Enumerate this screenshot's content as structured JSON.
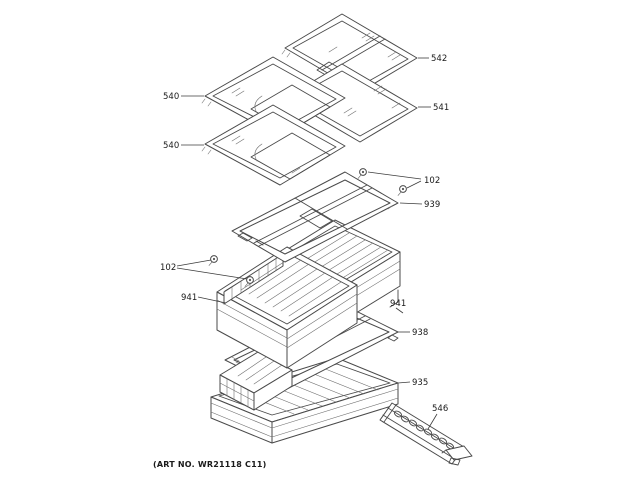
{
  "figure": {
    "art_no": "(ART NO. WR21118 C11)"
  },
  "callouts": {
    "shelf_542": "542",
    "shelf_540_upper": "540",
    "shelf_541": "541",
    "shelf_540_lower": "540",
    "fasteners_102_top": "102",
    "cover_frame_939": "939",
    "fasteners_102_left": "102",
    "pan_941_left": "941",
    "pan_941_right": "941",
    "frame_938": "938",
    "pan_935": "935",
    "rack_546": "546"
  },
  "colors": {
    "background": "#ffffff",
    "line": "#4a4a4a",
    "label_text": "#1a1a1a"
  }
}
